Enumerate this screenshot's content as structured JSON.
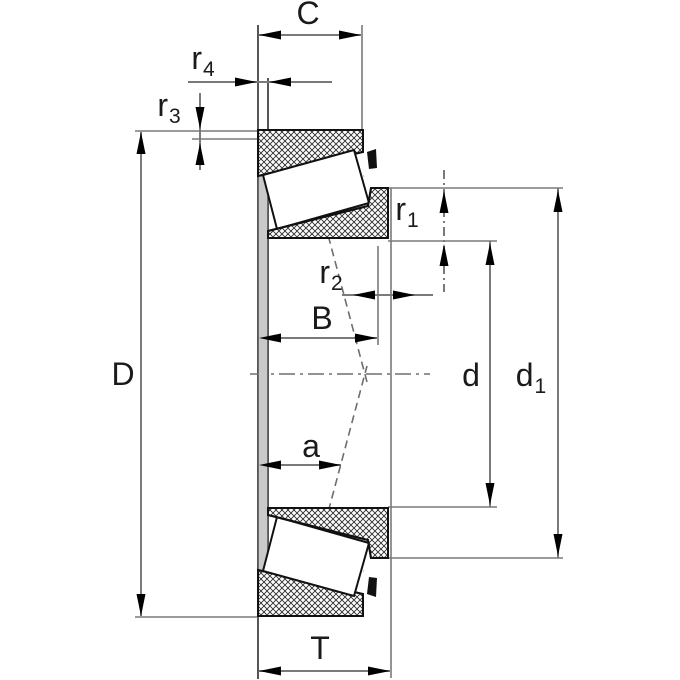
{
  "title": "Tapered roller bearing dimension drawing",
  "colors": {
    "background": "#ffffff",
    "outline": "#111111",
    "dim_line": "#7a7a7a",
    "face_band_fill": "#c9c9c9",
    "label": "#1a1a1a"
  },
  "dimension_names": [
    "C",
    "r4",
    "r3",
    "D",
    "B",
    "r2",
    "a",
    "r1",
    "d",
    "d1",
    "T"
  ],
  "labels": {
    "C": {
      "text": "C"
    },
    "r4": {
      "base": "r",
      "sub": "4"
    },
    "r3": {
      "base": "r",
      "sub": "3"
    },
    "D": {
      "text": "D"
    },
    "B": {
      "text": "B"
    },
    "r2": {
      "base": "r",
      "sub": "2"
    },
    "a": {
      "text": "a"
    },
    "r1": {
      "base": "r",
      "sub": "1"
    },
    "d": {
      "text": "d"
    },
    "d1": {
      "base": "d",
      "sub": "1"
    },
    "T": {
      "text": "T"
    }
  }
}
